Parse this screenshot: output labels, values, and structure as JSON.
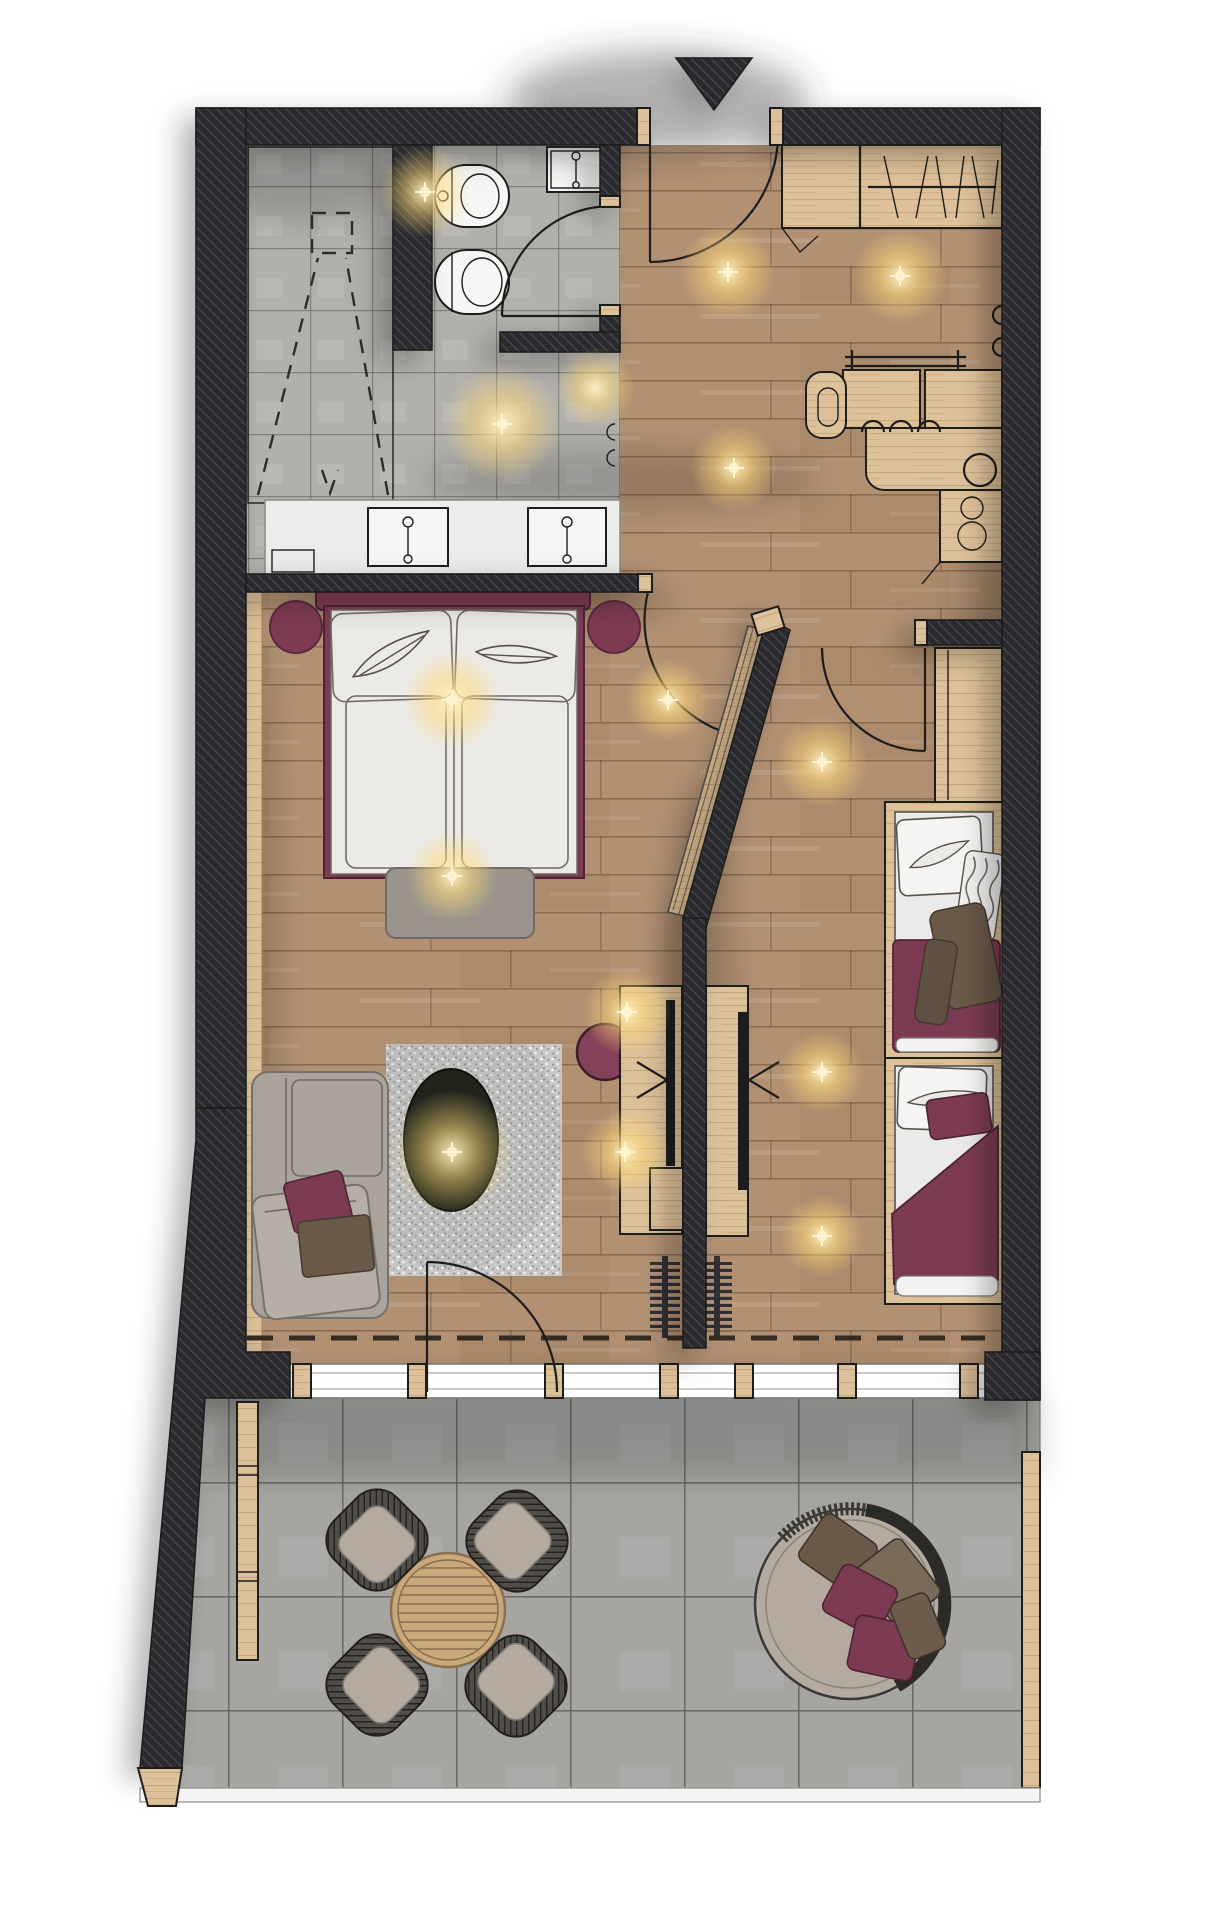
{
  "colors": {
    "ink": "#1d1d1b",
    "wall": "#2a2a2e",
    "wallHatch": "#45454c",
    "wood": "#b29173",
    "woodLine": "#8a6a4c",
    "pine": "#ddc19a",
    "pineLine": "#a5825a",
    "btile": "#b2b0ad",
    "grout": "#8f8d89",
    "ttile": "#a6a5a2",
    "tgrout": "#7d7c79",
    "linen": "#eceae7",
    "burgundy": "#7d3b53",
    "burgundyDeep": "#5a2a3c",
    "sofa": "#aba49c",
    "bench": "#9a948c",
    "rug": "#c8c8c6",
    "tableDark": "#20241b",
    "wicker": "#514e4a",
    "cushion": "#b4aa9f",
    "brown": "#6a5848",
    "radiator": "#303034",
    "glass": "#fdfdfc",
    "glow": "#ffe9a8"
  }
}
